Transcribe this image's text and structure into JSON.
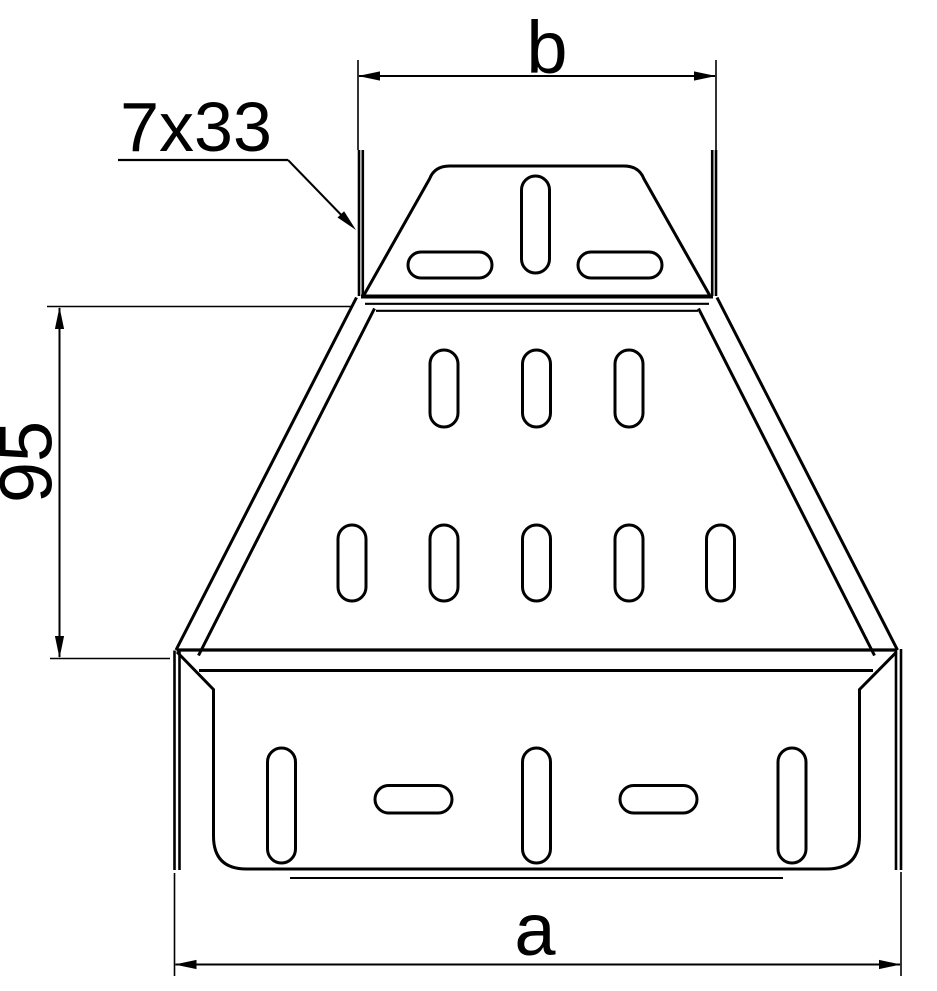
{
  "drawing": {
    "labels": {
      "top_width": "b",
      "bottom_width": "a",
      "side_height": "95",
      "slot_callout": "7x33"
    },
    "colors": {
      "line": "#000000",
      "background": "#ffffff"
    }
  }
}
